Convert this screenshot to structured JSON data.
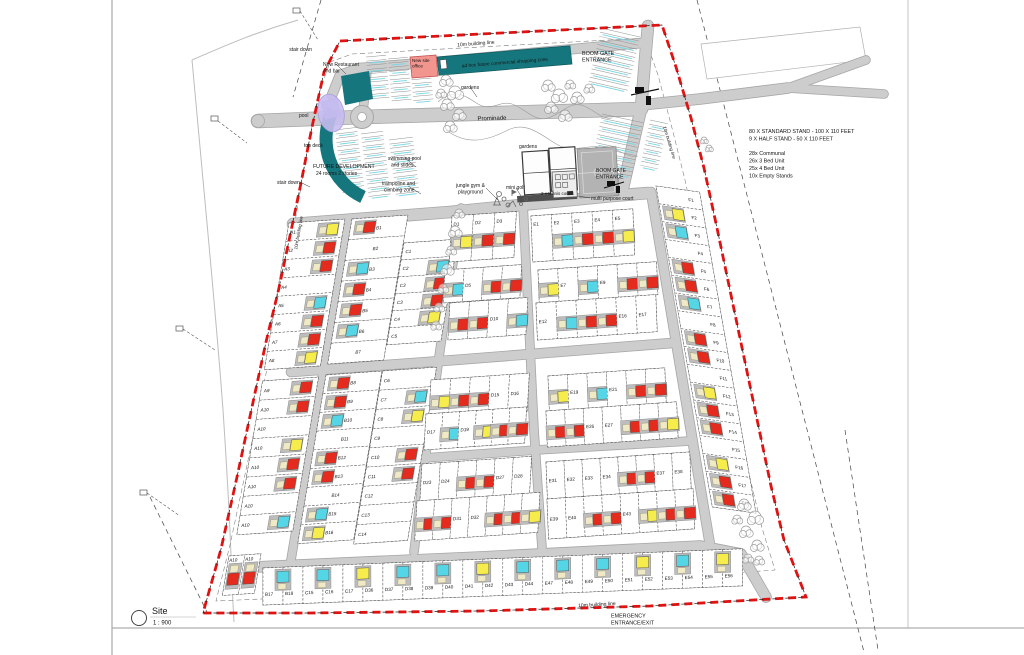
{
  "sheet": {
    "title": "Site",
    "sheet_number": "1",
    "scale": "1 : 900"
  },
  "notes": {
    "stand_info": [
      "80 X STANDARD STAND - 100 X 110 FEET",
      "9 X HALF STAND - 50 X 110 FEET"
    ],
    "unit_mix": [
      "28x Communal",
      "26x 3 Bed Unit",
      "25x 4 Bed Unit",
      "10x Empty Stands"
    ]
  },
  "colors": {
    "unit_red": "#e52a1e",
    "unit_yellow": "#f6ec4b",
    "unit_cyan": "#55d6e6",
    "unit_beige": "#efe9c5",
    "unit_base": "#bdbdbd",
    "teal": "#16767d",
    "office_pink": "#f2958f",
    "pool_purple": "#c6bcf0",
    "road": "#cdcdcd",
    "road_edge": "#a6a6a6",
    "boundary_red": "#e01313",
    "court_gray": "#b3b3b3"
  },
  "annotations": [
    {
      "t": "10m building  line",
      "x": 476,
      "y": 45,
      "s": 5,
      "r": -4.5,
      "a": "middle"
    },
    {
      "t": "BOOM GATE",
      "x": 582,
      "y": 55,
      "s": 5.4,
      "a": "start"
    },
    {
      "t": "ENTRANCE",
      "x": 582,
      "y": 61.5,
      "s": 5.4,
      "a": "start"
    },
    {
      "t": "stair down",
      "x": 312,
      "y": 51,
      "s": 5,
      "a": "end"
    },
    {
      "t": "New Restaurant",
      "x": 323,
      "y": 66,
      "s": 5,
      "a": "start"
    },
    {
      "t": "and bar",
      "x": 323,
      "y": 72.5,
      "s": 5,
      "a": "start"
    },
    {
      "t": "New site",
      "x": 412,
      "y": 62,
      "s": 4.6,
      "a": "start"
    },
    {
      "t": "office",
      "x": 412,
      "y": 67.5,
      "s": 4.6,
      "a": "start"
    },
    {
      "t": "ad hoc future commercial shopping zone",
      "x": 505,
      "y": 64,
      "s": 4.8,
      "r": -4.5,
      "a": "middle"
    },
    {
      "t": "gardens",
      "x": 461,
      "y": 89,
      "s": 5,
      "a": "start"
    },
    {
      "t": "pool",
      "x": 299,
      "y": 117,
      "s": 5,
      "a": "start"
    },
    {
      "t": "Prominade",
      "x": 492,
      "y": 120,
      "s": 6,
      "r": -1.5,
      "a": "middle"
    },
    {
      "t": "top deck",
      "x": 304,
      "y": 147,
      "s": 5,
      "a": "start"
    },
    {
      "t": "FUTURE DEVELOPMENT",
      "x": 313,
      "y": 168,
      "s": 5.2,
      "a": "start"
    },
    {
      "t": "24 rooms 2 stories",
      "x": 316,
      "y": 175,
      "s": 5,
      "a": "start"
    },
    {
      "t": "stair down",
      "x": 277,
      "y": 184,
      "s": 5,
      "a": "start"
    },
    {
      "t": "swimming pool",
      "x": 388,
      "y": 160,
      "s": 5,
      "a": "start"
    },
    {
      "t": "and slides",
      "x": 391,
      "y": 166.5,
      "s": 5,
      "a": "start"
    },
    {
      "t": "gardens",
      "x": 519,
      "y": 148,
      "s": 5,
      "a": "start"
    },
    {
      "t": "trampoline and",
      "x": 382,
      "y": 185,
      "s": 5,
      "a": "start"
    },
    {
      "t": "climbing zone",
      "x": 384,
      "y": 191.5,
      "s": 5,
      "a": "start"
    },
    {
      "t": "jungle gym &",
      "x": 456,
      "y": 187,
      "s": 5,
      "a": "start"
    },
    {
      "t": "playground",
      "x": 458,
      "y": 193.5,
      "s": 5,
      "a": "start"
    },
    {
      "t": "mini golf",
      "x": 506,
      "y": 189,
      "s": 5,
      "a": "start"
    },
    {
      "t": "2 x tennis courts",
      "x": 541,
      "y": 195,
      "s": 4.5,
      "a": "start"
    },
    {
      "t": "BOOM GATE",
      "x": 596,
      "y": 172,
      "s": 5,
      "a": "start"
    },
    {
      "t": "ENTRANCE",
      "x": 596,
      "y": 178.5,
      "s": 5,
      "a": "start"
    },
    {
      "t": "multi purpose court",
      "x": 591,
      "y": 200,
      "s": 5,
      "a": "start"
    },
    {
      "t": "80 X STANDARD STAND - 100 X 110 FEET",
      "x": 749,
      "y": 133,
      "s": 5.4,
      "a": "start"
    },
    {
      "t": "9 X HALF STAND - 50 X 110 FEET",
      "x": 749,
      "y": 140.5,
      "s": 5.4,
      "a": "start"
    },
    {
      "t": "28x Communal",
      "x": 749,
      "y": 155,
      "s": 5.4,
      "a": "start"
    },
    {
      "t": "26x 3 Bed Unit",
      "x": 749,
      "y": 162.5,
      "s": 5.4,
      "a": "start"
    },
    {
      "t": "25x 4 Bed Unit",
      "x": 749,
      "y": 170,
      "s": 5.4,
      "a": "start"
    },
    {
      "t": "10x Empty Stands",
      "x": 749,
      "y": 177.5,
      "s": 5.4,
      "a": "start"
    },
    {
      "t": "10m building line",
      "x": 300,
      "y": 233,
      "s": 4.5,
      "r": -80,
      "a": "middle"
    },
    {
      "t": "10m building line",
      "x": 668,
      "y": 143,
      "s": 4.5,
      "r": 73,
      "a": "middle"
    },
    {
      "t": "10m building  line",
      "x": 597,
      "y": 606,
      "s": 5,
      "r": -3.5,
      "a": "middle"
    },
    {
      "t": "EMERGENCY",
      "x": 611,
      "y": 617.5,
      "s": 5.4,
      "a": "start"
    },
    {
      "t": "ENTRANCE/EXIT",
      "x": 611,
      "y": 624.5,
      "s": 5.4,
      "a": "start"
    },
    {
      "t": "Site",
      "x": 152,
      "y": 614,
      "s": 9,
      "a": "start"
    },
    {
      "t": "1 : 900",
      "x": 153,
      "y": 624.5,
      "s": 6,
      "a": "start"
    },
    {
      "t": "1",
      "x": 139,
      "y": 621,
      "s": 7,
      "a": "middle"
    }
  ],
  "blocks": {
    "A_upper": [
      [
        "A1",
        "yellow"
      ],
      [
        "A2",
        "red"
      ],
      [
        "A3",
        "red"
      ],
      [
        "A4",
        null
      ],
      [
        "A5",
        "cyan"
      ],
      [
        "A6",
        "red"
      ],
      [
        "A7",
        "red"
      ],
      [
        "A8",
        "yellow"
      ]
    ],
    "A_lower": [
      [
        "A9",
        "red"
      ],
      [
        "A10",
        "red"
      ],
      [
        "A10",
        null
      ],
      [
        "A10",
        "yellow"
      ],
      [
        "A10",
        "red"
      ],
      [
        "A10",
        "red"
      ],
      [
        "A10",
        null
      ],
      [
        "A10",
        "cyan"
      ]
    ],
    "B_upper": [
      [
        "B1",
        "red"
      ],
      [
        "B2",
        null
      ],
      [
        "B3",
        "cyan"
      ],
      [
        "B4",
        "red"
      ],
      [
        "B5",
        "red"
      ],
      [
        "B6",
        "cyan"
      ],
      [
        "B7",
        null
      ]
    ],
    "B_lower": [
      [
        "B8",
        "red"
      ],
      [
        "B9",
        "red"
      ],
      [
        "B10",
        "cyan"
      ],
      [
        "B11",
        null
      ],
      [
        "B12",
        "red"
      ],
      [
        "B13",
        "red"
      ],
      [
        "B14",
        null
      ],
      [
        "B15",
        "cyan"
      ],
      [
        "B16",
        "yellow"
      ]
    ],
    "C_upper": [
      [
        "C1",
        null
      ],
      [
        "C2",
        "cyan"
      ],
      [
        "C3",
        "red"
      ],
      [
        "C3",
        "red"
      ],
      [
        "C4",
        "yellow"
      ],
      [
        "C5",
        null
      ]
    ],
    "C_lower": [
      [
        "C6",
        null
      ],
      [
        "C7",
        "cyan"
      ],
      [
        "C8",
        "yellow"
      ],
      [
        "C9",
        null
      ],
      [
        "C10",
        "red"
      ],
      [
        "C11",
        "red"
      ],
      [
        "C12",
        null
      ],
      [
        "C13",
        null
      ],
      [
        "C14",
        null
      ]
    ],
    "D_rows": [
      [
        [
          "D1",
          "yellow"
        ],
        [
          "D2",
          "red"
        ],
        [
          "D3",
          "red"
        ]
      ],
      [
        [
          "D4",
          "cyan"
        ],
        [
          "D5",
          null
        ],
        [
          "D6",
          "red"
        ],
        [
          "D7",
          "red"
        ]
      ],
      [
        [
          "D8",
          "red"
        ],
        [
          "D9",
          "red"
        ],
        [
          "D10",
          null
        ],
        [
          "D11",
          "cyan"
        ]
      ],
      [
        [
          "D12",
          "yellow"
        ],
        [
          "D13",
          "red"
        ],
        [
          "D14",
          "red"
        ],
        [
          "D15",
          null
        ],
        [
          "D16",
          null
        ]
      ],
      [
        [
          "D17",
          null
        ],
        [
          "D18",
          "cyan"
        ],
        [
          "D19",
          null
        ],
        [
          "D20",
          "yellow"
        ],
        [
          "D21",
          "red"
        ],
        [
          "D22",
          "red"
        ]
      ],
      [
        [
          "D23",
          null
        ],
        [
          "D24",
          null
        ],
        [
          "D25",
          "red"
        ],
        [
          "D26",
          "red"
        ],
        [
          "D27",
          null
        ],
        [
          "D28",
          null
        ]
      ],
      [
        [
          "D29",
          "red"
        ],
        [
          "D30",
          "red"
        ],
        [
          "D31",
          null
        ],
        [
          "D32",
          null
        ],
        [
          "D33",
          "red"
        ],
        [
          "D34",
          "red"
        ],
        [
          "D35",
          "yellow"
        ]
      ]
    ],
    "E_rows": [
      [
        [
          "E1",
          null
        ],
        [
          "E2",
          "cyan"
        ],
        [
          "E3",
          "red"
        ],
        [
          "E4",
          "red"
        ],
        [
          "E5",
          "yellow"
        ]
      ],
      [
        [
          "E6",
          "yellow"
        ],
        [
          "E7",
          null
        ],
        [
          "E8",
          "cyan"
        ],
        [
          "E9",
          null
        ],
        [
          "E10",
          "red"
        ],
        [
          "E11",
          "red"
        ]
      ],
      [
        [
          "E12",
          null
        ],
        [
          "E13",
          "cyan"
        ],
        [
          "E14",
          "red"
        ],
        [
          "E15",
          "red"
        ],
        [
          "E16",
          null
        ],
        [
          "E17",
          null
        ]
      ],
      [
        [
          "E18",
          "yellow"
        ],
        [
          "E19",
          null
        ],
        [
          "E20",
          "cyan"
        ],
        [
          "E21",
          null
        ],
        [
          "E22",
          "red"
        ],
        [
          "E23",
          "red"
        ]
      ],
      [
        [
          "E24",
          "red"
        ],
        [
          "E25",
          "red"
        ],
        [
          "E26",
          null
        ],
        [
          "E27",
          null
        ],
        [
          "E28",
          "red"
        ],
        [
          "E29",
          "red"
        ],
        [
          "E30",
          "yellow"
        ]
      ],
      [
        [
          "E31",
          null
        ],
        [
          "E32",
          null
        ],
        [
          "E33",
          null
        ],
        [
          "E34",
          null
        ],
        [
          "E35",
          "red"
        ],
        [
          "E36",
          "red"
        ],
        [
          "E37",
          null
        ],
        [
          "E38",
          null
        ]
      ],
      [
        [
          "E39",
          null
        ],
        [
          "E40",
          null
        ],
        [
          "E41",
          "red"
        ],
        [
          "E42",
          "red"
        ],
        [
          "E43",
          null
        ],
        [
          "E44",
          "yellow"
        ],
        [
          "E45",
          "red"
        ],
        [
          "E46",
          "red"
        ]
      ]
    ],
    "F_col": [
      [
        "F1",
        null
      ],
      [
        "F2",
        "yellow"
      ],
      [
        "F3",
        "cyan"
      ],
      [
        "F4",
        null
      ],
      [
        "F5",
        "red"
      ],
      [
        "F6",
        "red"
      ],
      [
        "F7",
        "cyan"
      ],
      [
        "F8",
        null
      ],
      [
        "F9",
        "red"
      ],
      [
        "F10",
        "red"
      ],
      [
        "F11",
        null
      ],
      [
        "F12",
        "yellow"
      ],
      [
        "F13",
        "red"
      ],
      [
        "F14",
        "red"
      ],
      [
        "F15",
        null
      ],
      [
        "F16",
        "yellow"
      ],
      [
        "F17",
        "red"
      ],
      [
        "F18",
        "red"
      ]
    ],
    "bottom_row": {
      "lots": [
        "B17",
        "B18",
        "C15",
        "C16",
        "C17",
        "D36",
        "D37",
        "D38",
        "D39",
        "D40",
        "D41",
        "D42",
        "D43",
        "D44",
        "E47",
        "E48",
        "E49",
        "E50",
        "E51",
        "E52",
        "E53",
        "E54",
        "E55",
        "E56"
      ],
      "pair_units": [
        "cyan",
        "cyan",
        "yellow",
        "cyan",
        "cyan",
        "yellow",
        "cyan",
        "cyan",
        "cyan",
        "yellow",
        "cyan",
        "yellow"
      ]
    },
    "corner": [
      [
        "A10",
        "red"
      ],
      [
        "A10",
        "red"
      ]
    ]
  }
}
